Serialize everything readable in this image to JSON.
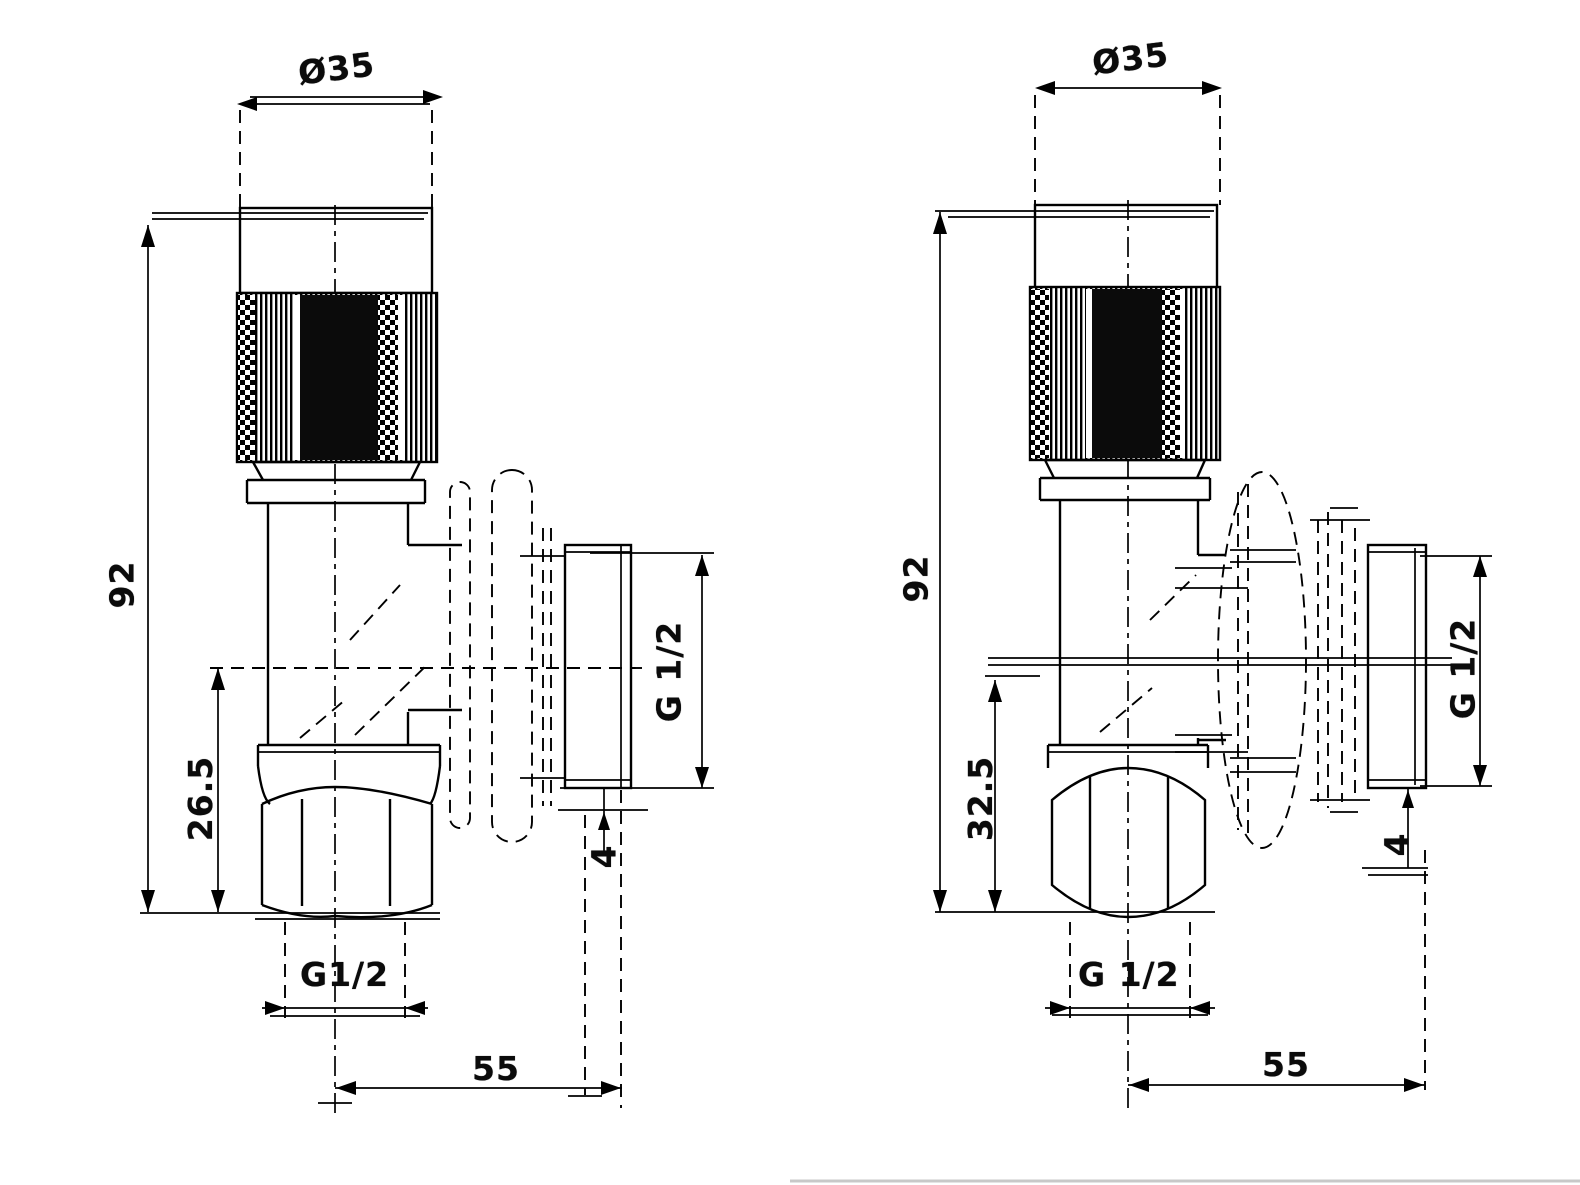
{
  "colors": {
    "line": "#000000",
    "background": "#ffffff",
    "faint_rule": "#c8c8c8"
  },
  "left_view": {
    "dims": {
      "top_diameter": "Ø35",
      "height": "92",
      "bottom_offset": "26.5",
      "outlet_thread": "G 1/2",
      "step": "4",
      "inlet_thread": "G1/2",
      "depth": "55"
    }
  },
  "right_view": {
    "dims": {
      "top_diameter": "Ø35",
      "height": "92",
      "bottom_offset": "32.5",
      "outlet_thread": "G 1/2",
      "step": "4",
      "inlet_thread": "G 1/2",
      "depth": "55"
    }
  }
}
